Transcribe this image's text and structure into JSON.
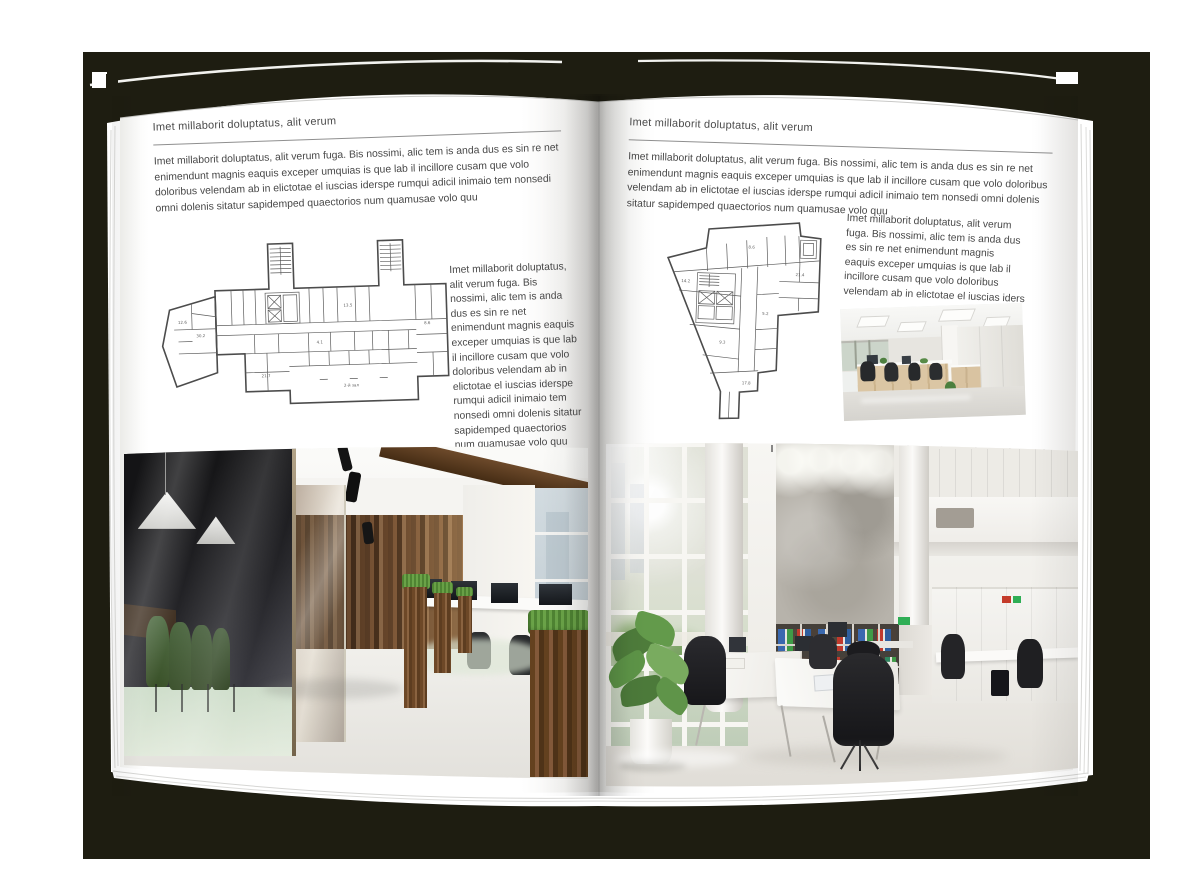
{
  "scene": {
    "backdrop_color": "#1e1d11",
    "page_color": "#ffffff"
  },
  "left_page": {
    "header": "Imet millaborit doluptatus, alit verum",
    "intro": "Imet millaborit doluptatus, alit verum fuga. Bis nossimi, alic tem is anda dus es sin re net enimendunt magnis eaquis exceper umquias is que lab il incillore cusam que volo doloribus velendam ab in elictotae el iuscias iderspe rumqui adicil inimaio tem nonsedi omni dolenis sitatur sapidemped quaectorios num quamusae volo quu",
    "side_text": "Imet millaborit doluptatus, alit verum fuga. Bis nossimi, alic tem is anda dus es sin re net enimendunt magnis eaquis exceper umquias is que lab il incillore cusam que volo doloribus velendam ab in elictotae el iuscias iderspe rumqui adicil inimaio tem nonsedi omni dolenis sitatur sapidemped quaectorios num quamusae volo quu",
    "floor_plan": {
      "name": "wide-building-floor-plan",
      "labels": [
        "12.6",
        "30.2",
        "21.7",
        "13.5",
        "4.1",
        "8.6",
        "2-й зал"
      ]
    },
    "photo": {
      "name": "office-photo-dark-wood-interior",
      "description": "Office interior with dark glass meeting room, green chairs, pendant lamps, wooden wall, planters and desks with monitors"
    }
  },
  "right_page": {
    "header": "Imet millaborit doluptatus, alit verum",
    "intro": "Imet millaborit doluptatus, alit verum fuga. Bis nossimi, alic tem is anda dus es sin re net enimendunt magnis eaquis exceper umquias is que lab il incillore cusam que volo doloribus velendam ab in elictotae el iuscias iderspe rumqui adicil inimaio tem nonsedi omni dolenis sitatur sapidemped quaectorios num quamusae volo quu",
    "side_text": "Imet millaborit doluptatus, alit verum fuga. Bis nossimi, alic tem is anda dus es sin re net enimendunt magnis eaquis exceper umquias is que lab il incillore cusam que volo doloribus velendam ab in elictotae el iuscias iders",
    "floor_plan": {
      "name": "irregular-building-floor-plan",
      "labels": [
        "14.2",
        "8.6",
        "21.4",
        "5.2",
        "9.3",
        "17.8"
      ]
    },
    "photo_small": {
      "name": "office-photo-open-space",
      "description": "Bright open-plan office with LED ceiling panels, desk rows with wooden cabinets and black chairs"
    },
    "photo": {
      "name": "office-photo-loft-interior",
      "description": "Double-height white office with tall windows, concrete feature wall, shelving with colorful binders, white desks and black chairs"
    }
  }
}
